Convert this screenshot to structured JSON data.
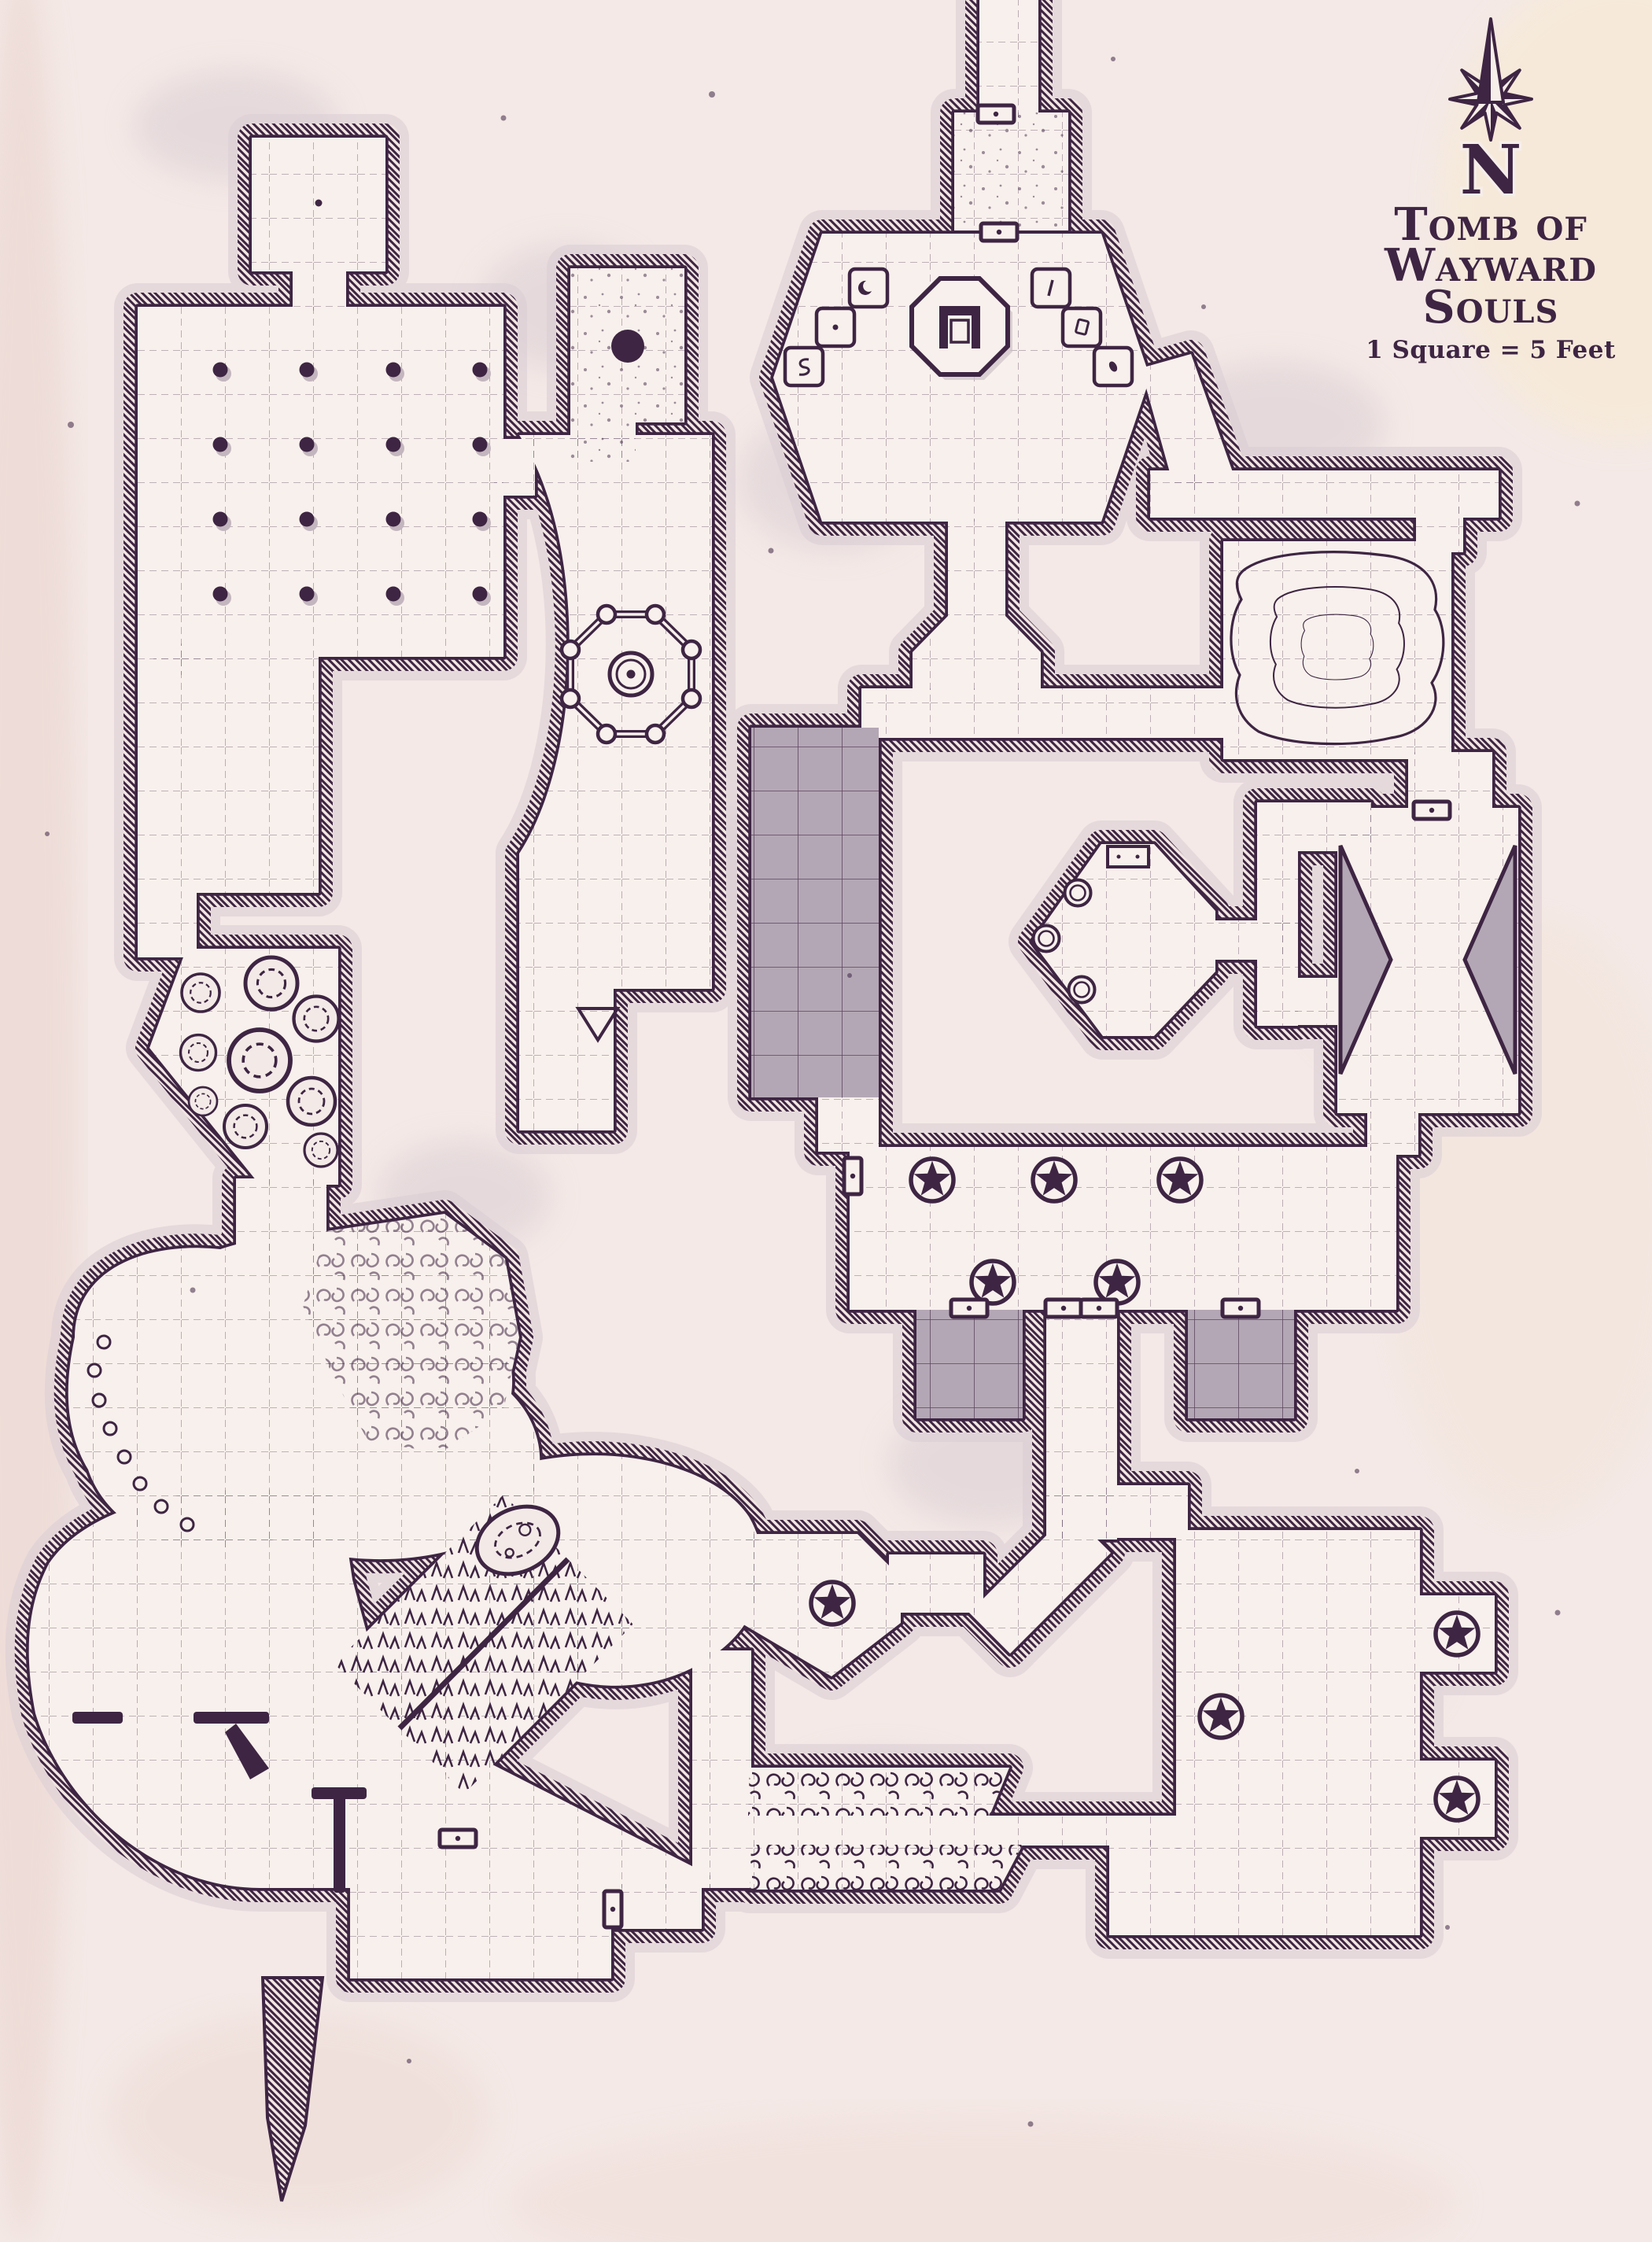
{
  "title_block": {
    "compass_letter": "N",
    "title_line_1": "Tomb of",
    "title_line_2": "Wayward Souls",
    "scale_note": "1 Square = 5 Feet"
  },
  "palette": {
    "ink": "#3e2543",
    "parchment": "#f4e9e6",
    "floor": "#f8f0ec",
    "stone_gray": "#b4a7b5",
    "smudge": "#dccfd6"
  },
  "map_features": [
    {
      "name": "compass-rose",
      "count": 1
    },
    {
      "name": "star-sigil",
      "count": 9
    },
    {
      "name": "door",
      "count": 10
    },
    {
      "name": "pillar",
      "count": 16
    },
    {
      "name": "rune-plinth",
      "count": 6
    },
    {
      "name": "throne-dais",
      "count": 1
    },
    {
      "name": "fenced-well",
      "count": 1
    },
    {
      "name": "well",
      "count": 3
    },
    {
      "name": "water-pool",
      "count": 1
    },
    {
      "name": "boulder",
      "count": 10
    },
    {
      "name": "pebble",
      "count": 8
    },
    {
      "name": "spiked-passage",
      "count": 2
    },
    {
      "name": "bramble-pit",
      "count": 2
    },
    {
      "name": "thicket-patch",
      "count": 1
    },
    {
      "name": "rubble-field",
      "count": 1
    },
    {
      "name": "pit",
      "count": 1
    },
    {
      "name": "cavern",
      "count": 1
    },
    {
      "name": "ruined-courtyard",
      "count": 1
    },
    {
      "name": "stone-platform",
      "count": 3
    },
    {
      "name": "stone-wedge",
      "count": 2
    },
    {
      "name": "wall-cap",
      "count": 4
    },
    {
      "name": "hatched-spur",
      "count": 1
    }
  ]
}
